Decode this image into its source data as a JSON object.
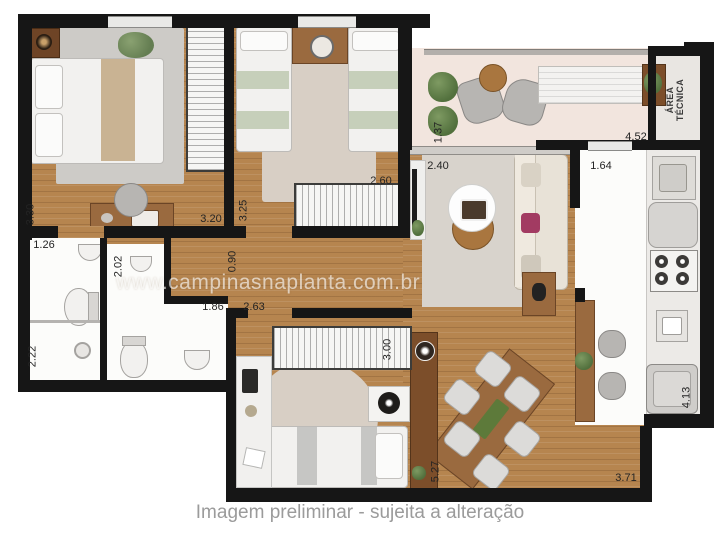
{
  "watermark": "www.campinasnaplanta.com.br",
  "caption": "Imagem preliminar - sujeita a alteração",
  "labels": {
    "area_tecnica": "ÁREA TÉCNICA"
  },
  "dimensions": {
    "bedroom1_height": "3.30",
    "bedroom1_width": "3.20",
    "bedroom2_height": "3.25",
    "bedroom2_width": "2.60",
    "balcony_height": "1.37",
    "balcony_width": "4.52",
    "living_width": "2.40",
    "kitchen_width": "1.64",
    "hall_width": "0.90",
    "bathroom1_width": "1.26",
    "bathroom2_height": "2.02",
    "bathroom2_width": "1.86",
    "bathroom1_height": "2.22",
    "bedroom3_width": "2.63",
    "bedroom3_height": "3.00",
    "dining_height": "5.27",
    "dining_width": "3.71",
    "kitchen_height": "4.13"
  },
  "palette": {
    "wood_floor": "#b6854f",
    "wall": "#161616",
    "balcony_floor": "#f2e5de",
    "technical_floor": "#e9e6e2",
    "rug_gray": "#cdcbc7",
    "rug_beige": "#d8cfc5",
    "bed_stripe_green": "#c6cfba",
    "accent_pillow": "#a23b62",
    "plant_green": "#5f7f4a",
    "caption_gray": "#9b9b9b"
  }
}
